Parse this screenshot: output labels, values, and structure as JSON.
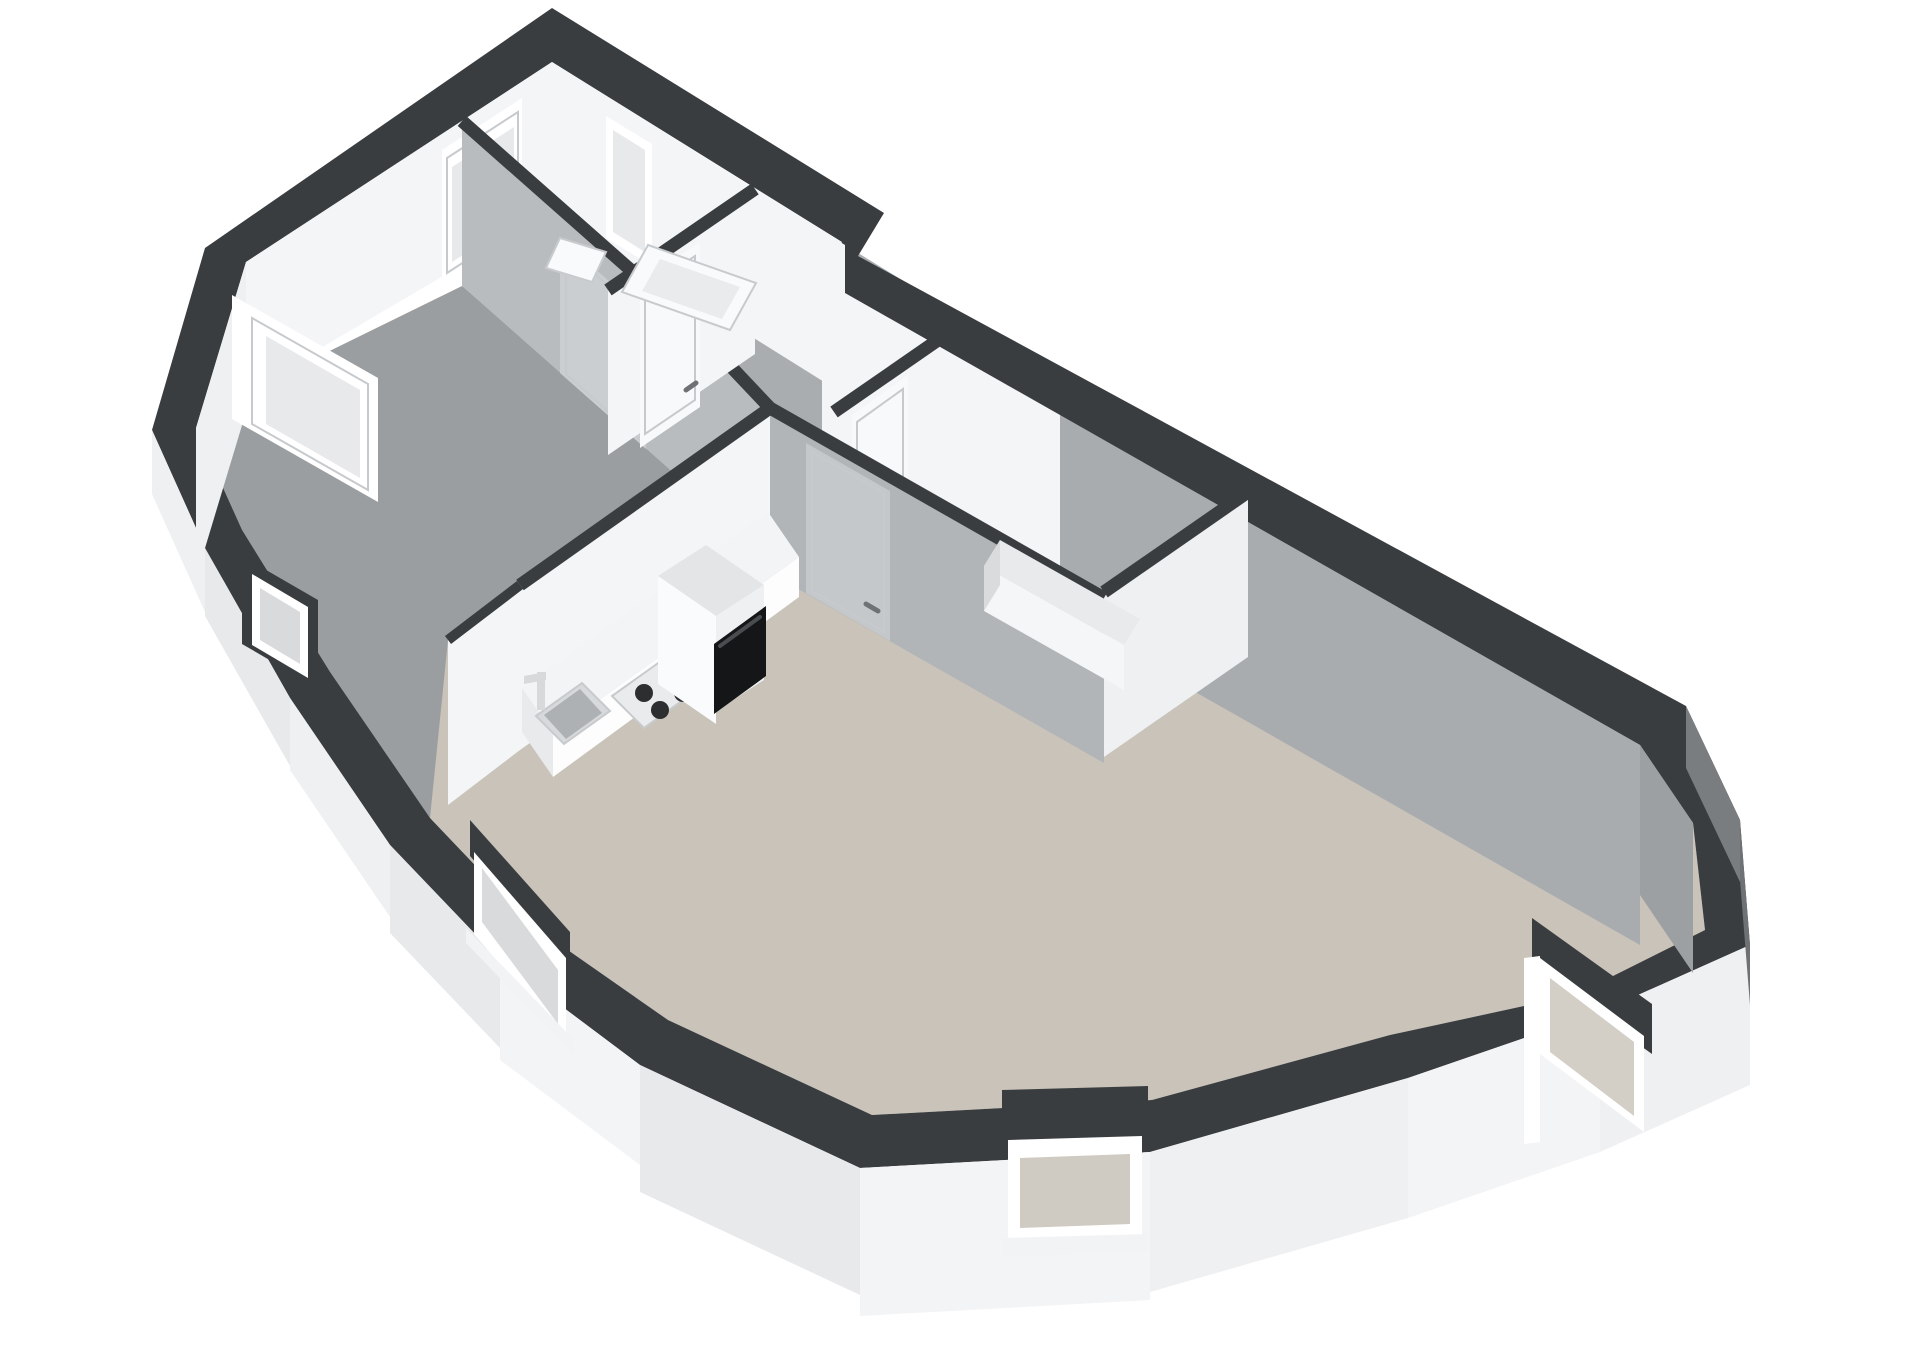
{
  "title": "3D isometric floor plan of a one-bedroom apartment, viewed from above at an angle on a white background",
  "colors": {
    "background": "#ffffff",
    "wallTop": "#3a3d40",
    "outerFaceWhite": "#eef0f1",
    "outerFaceWhite2": "#e7e9eb",
    "outerFaceWhite3": "#f3f4f5",
    "outerFaceGray": "#6f7275",
    "outerFaceGray2": "#7a7d80",
    "innerFaceLit": "#f4f5f6",
    "innerFaceLit2": "#eef0f2",
    "innerFaceShaded": "#b9bcbf",
    "innerFaceShadedDark": "#a9acaf",
    "innerFaceGrayDeep": "#9da0a3",
    "hallWallFace": "#b2b5b8",
    "floorBedroom": "#9b9ea1",
    "floorHall": "#aaadb0",
    "floorBathroom": "#e3e5e7",
    "floorLiving": "#c9c3b9",
    "doorShaded": "#cbced1",
    "doorLit": "#f8f9fa",
    "doorHallShaded": "#c5c8cb",
    "windowFrame": "#ffffff",
    "windowGlass": "#e7e9ea",
    "windowGlassCool": "#d8dadc",
    "windowGlassWarm": "#cfcac2",
    "windowGlassWarm2": "#d3cec6",
    "windowSill": "#f2f3f4",
    "frameLine": "#c7cacc",
    "counterTop": "#f3f4f6",
    "counterFront": "#fdfdfe",
    "counterEnd": "#e8eaec",
    "steelDark": "#aeb1b3",
    "steelLight": "#d7d9db",
    "hobFace": "#e9ebec",
    "burner": "#2c2e30",
    "knob": "#55585a",
    "fridgeTop": "#e3e5e7",
    "fridgeLeft": "#fafbfc",
    "fridgeRight": "#eef0f2",
    "ovenBlack": "#141618",
    "ovenHandle": "#4a4d50",
    "tubOuter": "#f9fafb",
    "tubInner": "#e9ebed",
    "benchTop": "#e8eaec",
    "benchFront": "#f5f6f7",
    "benchEnd": "#d9dbdd",
    "fixtureEdge": "#c8cbcd",
    "handle": "#6f7275"
  },
  "scene": {
    "type": "3d-floorplan",
    "rooms": [
      {
        "name": "bedroom",
        "floor": "gray",
        "position": "upper-left"
      },
      {
        "name": "bathroom",
        "floor": "white",
        "position": "top-apex",
        "fixtures": [
          "bathtub",
          "basin"
        ]
      },
      {
        "name": "hallway",
        "floor": "gray",
        "position": "center",
        "doors": 4
      },
      {
        "name": "storage-room",
        "floor": "gray",
        "position": "upper-right",
        "fixtures": [
          "low-cabinet"
        ]
      },
      {
        "name": "living-room-kitchen",
        "floor": "beige",
        "position": "bottom",
        "fixtures": [
          "kitchen-counter",
          "sink",
          "gas-hob",
          "tall-cabinet",
          "built-in-oven"
        ]
      }
    ],
    "window_count": 7,
    "door_count": 4,
    "wall_style": "dark charcoal wall tops, white interior faces, cut-away exterior walls with windows"
  }
}
